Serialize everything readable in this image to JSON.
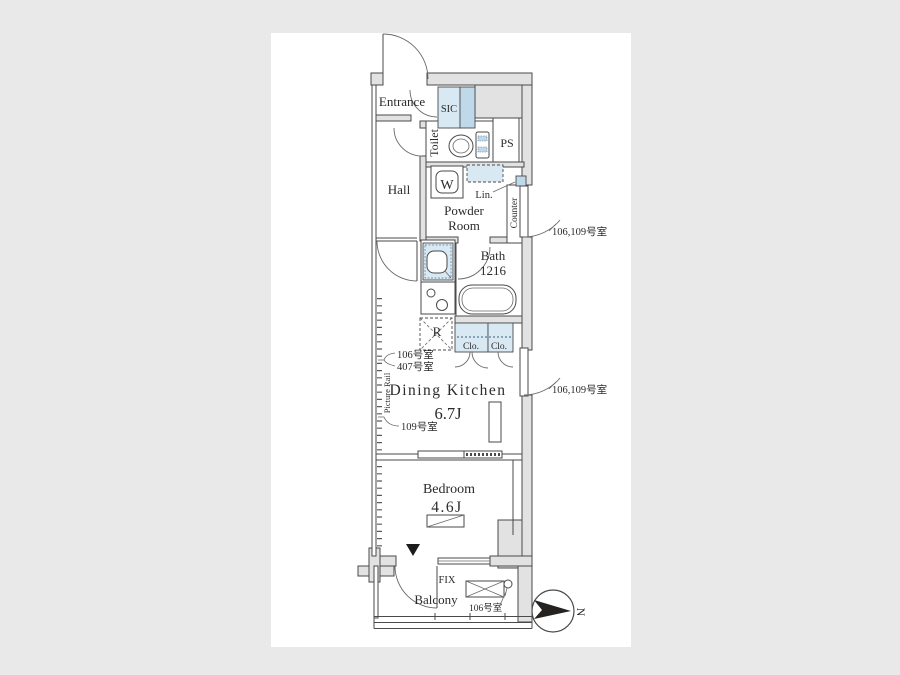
{
  "page": {
    "background": "#e9e9e9",
    "panel_background": "#ffffff"
  },
  "colors": {
    "wall_fill": "#e2e2e2",
    "line": "#4a4a4a",
    "fixture_blue": "#d9e9f4",
    "accent_blue": "#bfd8ea",
    "text": "#2b2b2b",
    "compass_fill": "#262220"
  },
  "floorplan": {
    "rooms": {
      "entrance": "Entrance",
      "sic": "SIC",
      "toilet": "Toilet",
      "pipe_space": "PS",
      "hall": "Hall",
      "washer": "W",
      "linen": "Lin.",
      "powder_room_line1": "Powder",
      "powder_room_line2": "Room",
      "counter": "Counter",
      "bath_name": "Bath",
      "bath_size": "1216",
      "refrigerator": "R",
      "closet_left": "Clo.",
      "closet_right": "Clo.",
      "dining_kitchen": "Dining Kitchen",
      "dining_kitchen_size": "6.7J",
      "bedroom": "Bedroom",
      "bedroom_size": "4.6J",
      "balcony": "Balcony",
      "fixed_window": "FIX",
      "picture_rail": "Picture Rail"
    },
    "callouts": {
      "hall_door": "106,109号室",
      "dk_door": "106,109号室",
      "rail_note_1": "106号室",
      "rail_note_2": "407号室",
      "rail_note_3": "109号室",
      "balcony_note": "106号室"
    },
    "compass": {
      "label": "N"
    }
  }
}
